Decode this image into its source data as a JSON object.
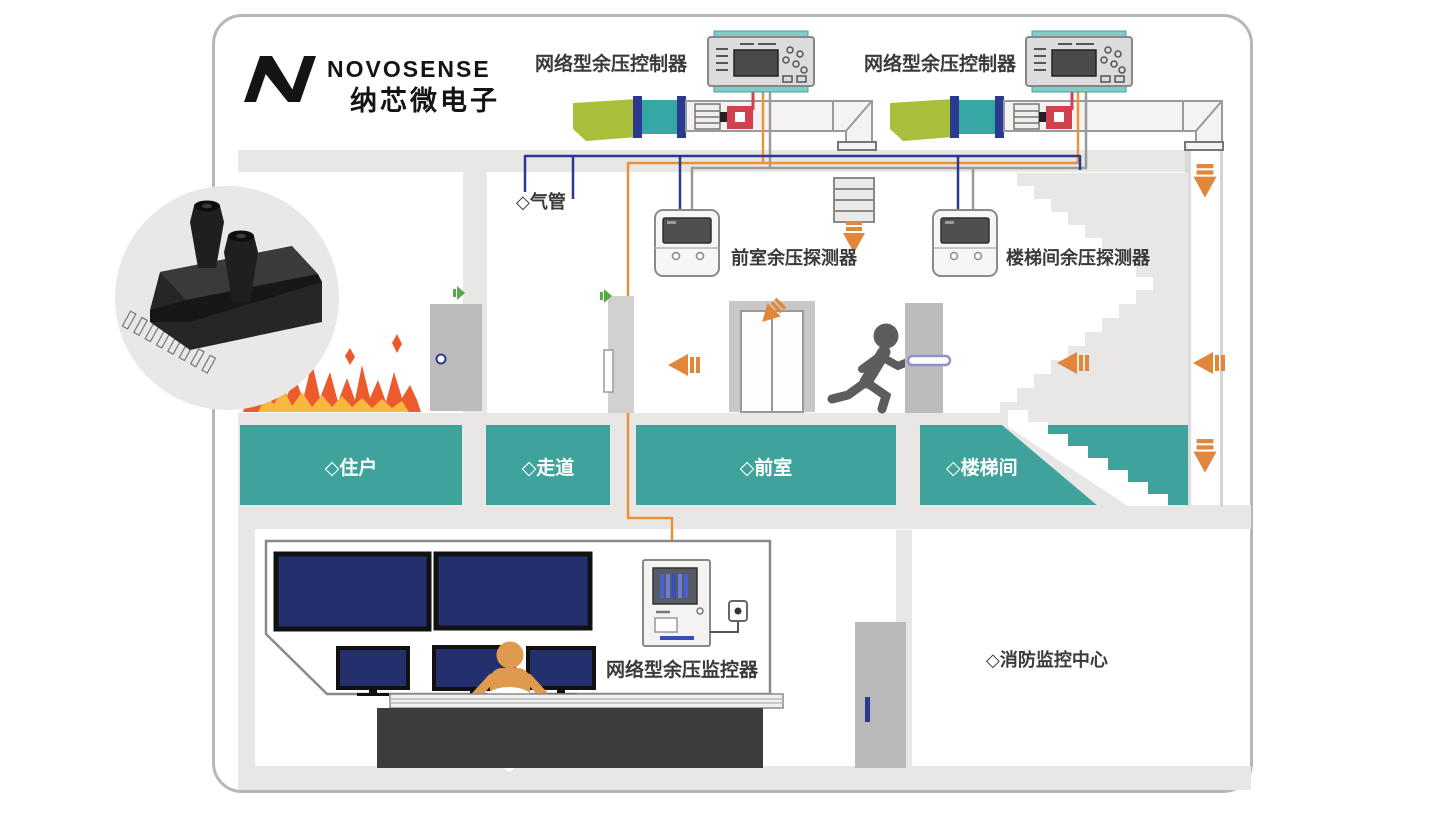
{
  "brand": {
    "name": "NOVOSENSE",
    "name_cn": "纳芯微电子"
  },
  "labels": {
    "controller_left": "网络型余压控制器",
    "controller_right": "网络型余压控制器",
    "air_pipe": "◇气管",
    "front_room_detector": "前室余压探测器",
    "stairwell_detector": "楼梯间余压探测器",
    "monitor": "网络型余压监控器",
    "fire_center": "◇消防监控中心"
  },
  "rooms": [
    {
      "label": "◇住户"
    },
    {
      "label": "◇走道"
    },
    {
      "label": "◇前室"
    },
    {
      "label": "◇楼梯间"
    }
  ],
  "icons": {
    "airflow_arrow": "orange-arrow",
    "alarm_sounder": "green-sounder",
    "fire": "flames",
    "evacuee": "running-person",
    "sensor_photo": "pressure-sensor-chip"
  },
  "colors": {
    "room_teal": "#3fa39c",
    "duct_green": "#a9bf3b",
    "duct_teal": "#35a7a4",
    "navy": "#2b3990",
    "arrow_orange": "#e0873b",
    "wire_orange": "#e8923a",
    "wire_gray": "#9a9a9a",
    "motor_red": "#d2424e",
    "screen_navy": "#24306e",
    "fire_orange": "#ed5a2d",
    "fire_yellow": "#f8b73e",
    "person_orange": "#df9a4e",
    "structure_gray": "#e8e7e5"
  }
}
